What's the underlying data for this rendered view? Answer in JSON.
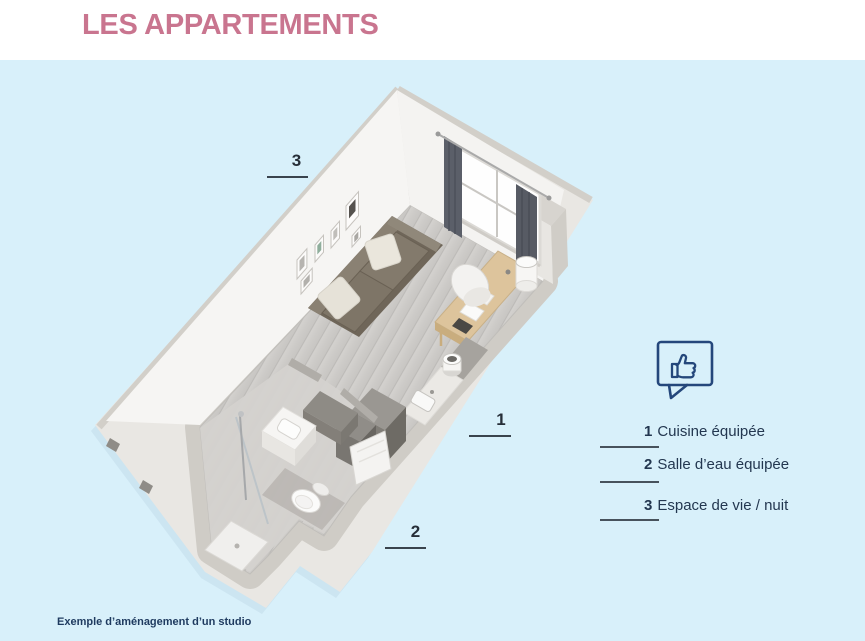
{
  "header": {
    "title": "LES APPARTEMENTS"
  },
  "floor_plan": {
    "markers": [
      {
        "number": "1"
      },
      {
        "number": "2"
      },
      {
        "number": "3"
      }
    ]
  },
  "legend": {
    "icon": "thumbs-up-speech-bubble",
    "items": [
      {
        "number": "1",
        "label": "Cuisine équipée"
      },
      {
        "number": "2",
        "label": "Salle d’eau équipée"
      },
      {
        "number": "3",
        "label": "Espace de vie / nuit"
      }
    ]
  },
  "caption": {
    "text": "Exemple d’aménagement d’un studio"
  },
  "colors": {
    "background": "#d8f0fa",
    "title": "#c9758f",
    "text_navy": "#233750",
    "icon_blue": "#24477b",
    "marker_line": "#39434d"
  }
}
